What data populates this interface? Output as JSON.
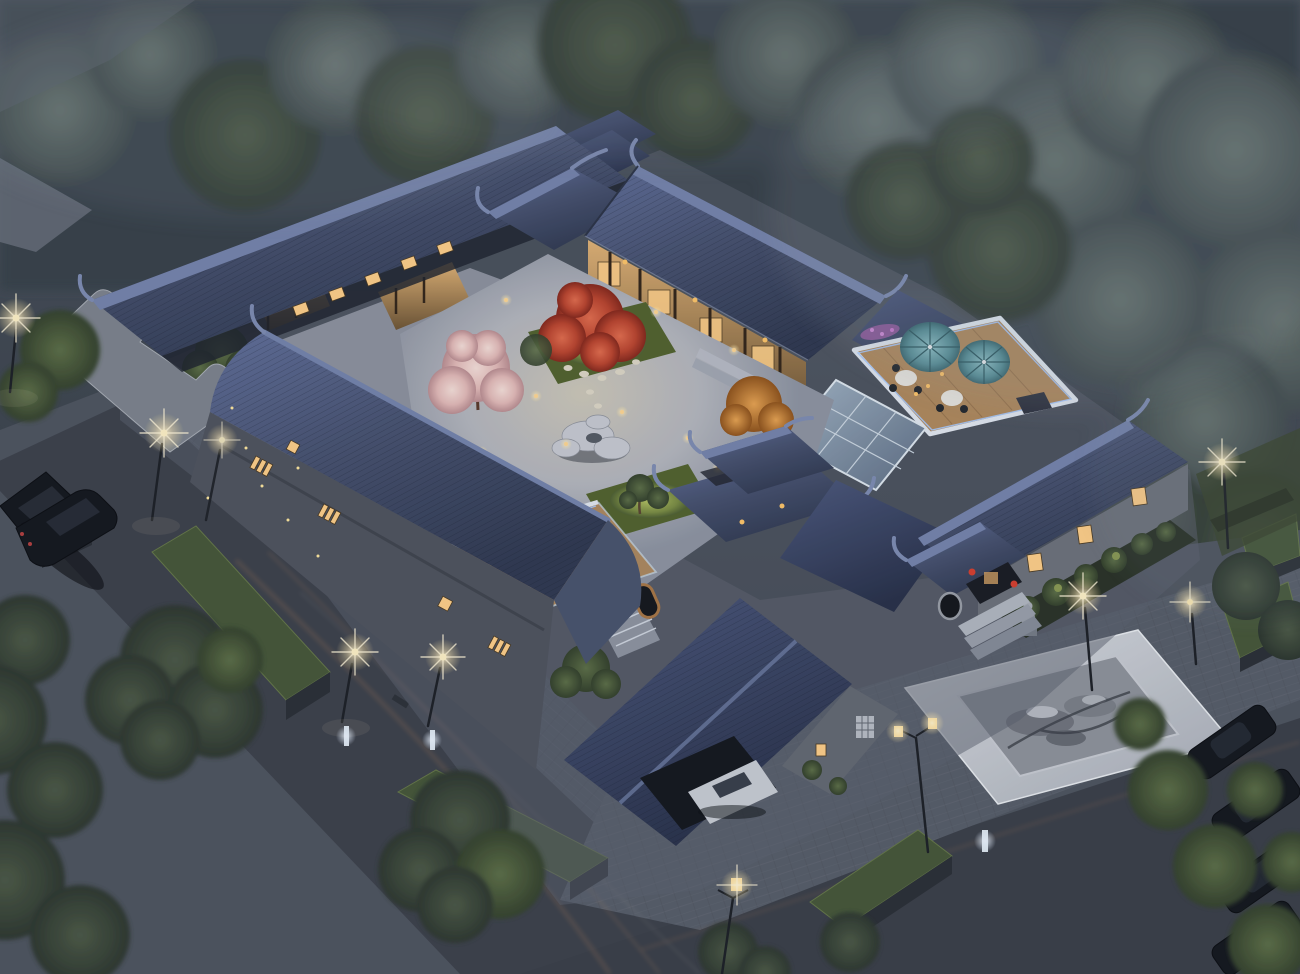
{
  "page": {
    "title": "Aerial dusk rendering — traditional Chinese courtyard residence"
  },
  "scene": {
    "description": "Bird's-eye dusk rendering of a traditional Chinese siheyuan courtyard compound with dark blue tiled roofs, a lit central courtyard garden with a red maple and a blossoming cherry tree, a rooftop parasol terrace, an open-air dining terrace, an entrance with a stone lion and red lanterns, surrounding stone-paved streets with lamps, planter beds, parked cars and misty trees",
    "time_of_day": "dusk",
    "style": "photorealistic 3D architectural visualization",
    "weather": "light evening mist"
  },
  "palette": {
    "sky_ground_base": "#3a424e",
    "roof_tile_light": "#5f6f9b",
    "roof_tile_dark": "#333d57",
    "brick_wall": "#4f545f",
    "warm_facade": "#d8ab72",
    "window_glow": "#ffd08a",
    "courtyard_paving": "#c2c4c8",
    "asphalt": "#3d424c",
    "sidewalk": "#515865",
    "marble_plaza": "#d6dade",
    "grass_lit": "#b9c967",
    "planter_grass": "#46583a",
    "maple_red": "#c04838",
    "cherry_pink": "#eccfc9",
    "autumn_orange": "#d08838",
    "parasol_teal": "#5f9ba3",
    "lamp_glow": "#fff3cf",
    "led_strip": "#a9cbff",
    "tree_mist": "#64716f"
  },
  "objects": {
    "buildings": [
      "northwest wing",
      "rear gatehouse",
      "north main hall with veranda",
      "northeast terrace block",
      "east entrance wing",
      "entrance gate",
      "inner pavilion gate",
      "southwest street wing",
      "garage wing with carport",
      "horse-head gable wall"
    ],
    "courtyard": [
      "central paved courtyard",
      "glowing garden bed with stepping stones",
      "second garden bed",
      "scholar rock feature",
      "red maple tree",
      "cherry blossom tree",
      "autumn orange tree",
      "bonsai pine",
      "path lanterns",
      "stone steps"
    ],
    "terraces": [
      "rooftop parasol terrace with two teal parasols, round tables and LED parapet",
      "glass skylight",
      "open-air dining terrace with round table, six diners and purple flower planters",
      "white stair with glass railing",
      "moon window"
    ],
    "street": [
      "left street with light trails",
      "bottom-right street",
      "herringbone sidewalk",
      "marble plaza with rock pond",
      "raised grass planter beds",
      "street lamps",
      "bollard lights",
      "park bench",
      "lawns and hedges"
    ],
    "vehicles": [
      "two dark sedans on left street",
      "white coupe inside carport",
      "row of four dark cars parked bottom-right"
    ],
    "nature": [
      "misty background tree canopy",
      "willow tree mass on the right",
      "foreground green trees",
      "fireflies over lawn"
    ]
  },
  "counts": {
    "teal_parasols": 2,
    "street_lamps": 9,
    "bollard_lights": 3,
    "planter_beds": 6,
    "cars_parked_right": 4,
    "cars_left_street": 2,
    "diners_on_terrace": 6,
    "courtyard_trees": 4,
    "stone_lions": 1,
    "red_lanterns": 2
  }
}
